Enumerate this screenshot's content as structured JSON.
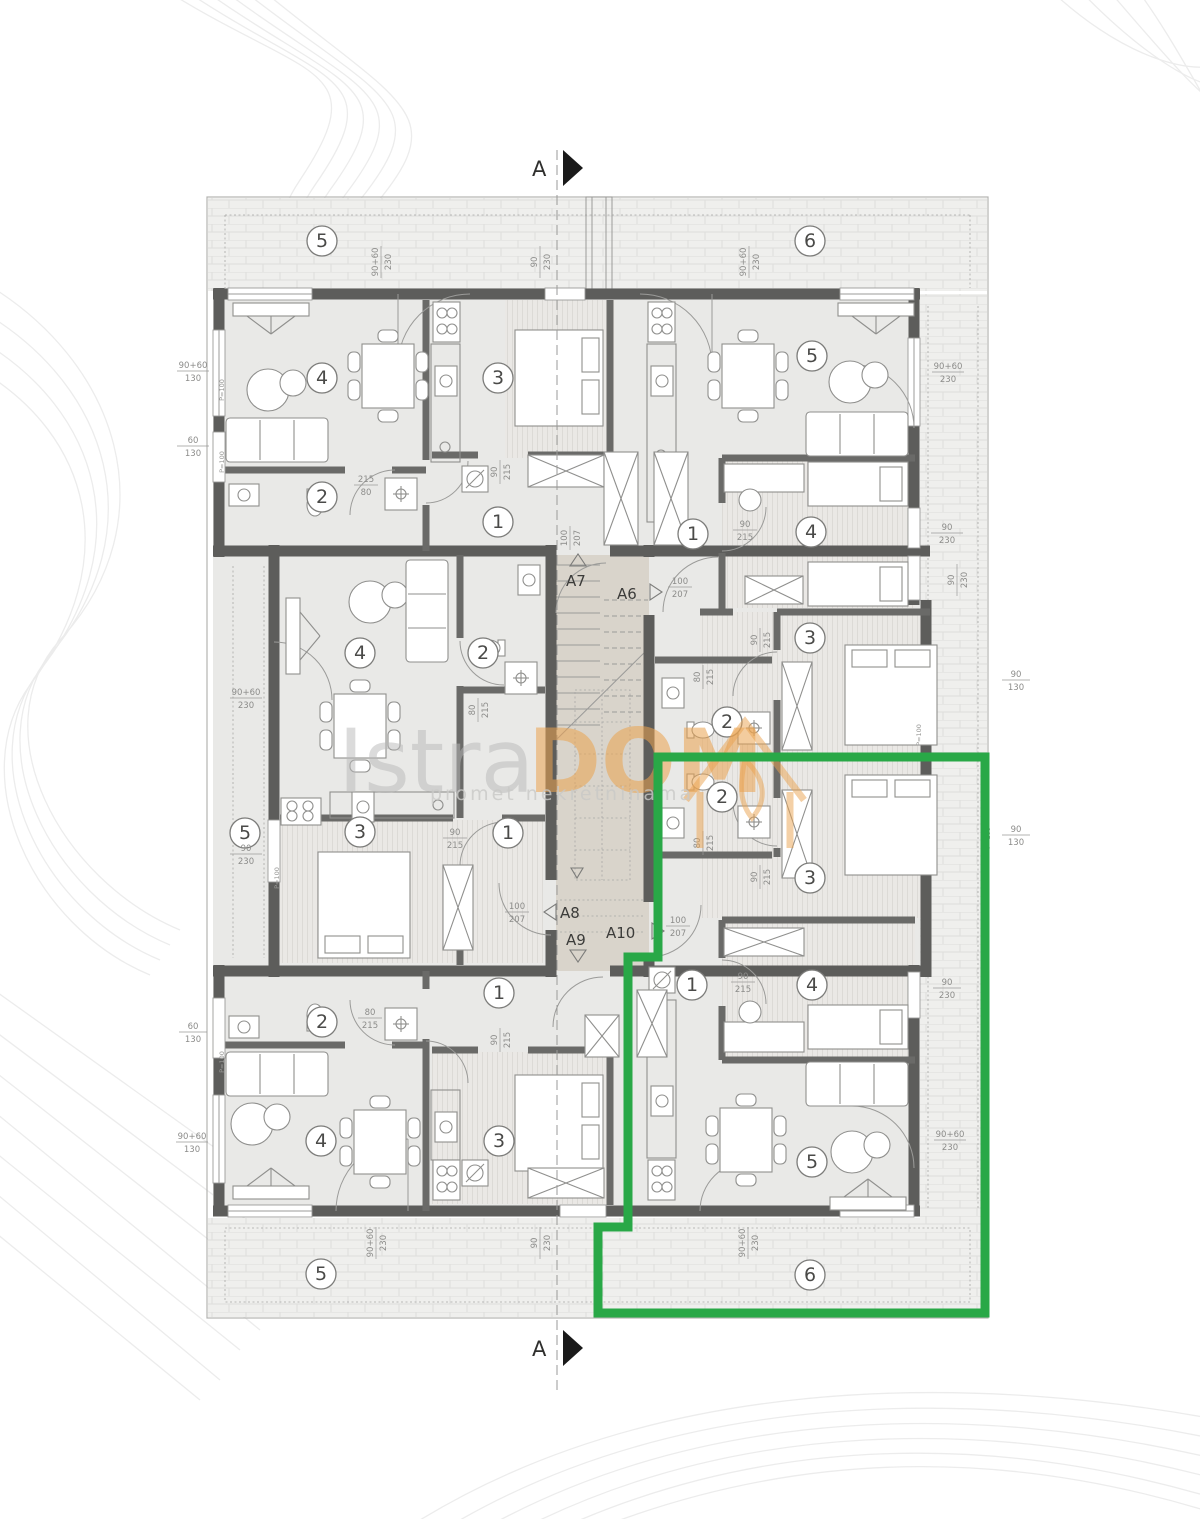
{
  "section": {
    "letter": "A"
  },
  "watermark": {
    "brand_gray": "Istra",
    "brand_orange": "DOM",
    "tagline": "promet nekretninama",
    "orange_hex": "#eba34f",
    "gray_hex": "#bdbdbd"
  },
  "colors": {
    "outline_green": "#29a847",
    "wall_gray": "#5d5d5b",
    "stair_fill": "#d9d4cb",
    "room_fill": "#e9e9e7"
  },
  "apartment_labels": [
    {
      "id": "a7",
      "text": "A7",
      "arrow": "up"
    },
    {
      "id": "a6",
      "text": "A6",
      "arrow": "right"
    },
    {
      "id": "a8",
      "text": "A8",
      "arrow": "left"
    },
    {
      "id": "a9",
      "text": "A9",
      "arrow": "down"
    },
    {
      "id": "a10",
      "text": "A10",
      "arrow": "right"
    }
  ],
  "rooms": [
    {
      "v": "5"
    },
    {
      "v": "4"
    },
    {
      "v": "3"
    },
    {
      "v": "2"
    },
    {
      "v": "1"
    },
    {
      "v": "6"
    },
    {
      "v": "5"
    },
    {
      "v": "1"
    },
    {
      "v": "4"
    },
    {
      "v": "3"
    },
    {
      "v": "2"
    },
    {
      "v": "5"
    },
    {
      "v": "4"
    },
    {
      "v": "2"
    },
    {
      "v": "3"
    },
    {
      "v": "1"
    },
    {
      "v": "2"
    },
    {
      "v": "3"
    },
    {
      "v": "1"
    },
    {
      "v": "4"
    },
    {
      "v": "5"
    },
    {
      "v": "6"
    },
    {
      "v": "2"
    },
    {
      "v": "1"
    },
    {
      "v": "4"
    },
    {
      "v": "3"
    },
    {
      "v": "5"
    }
  ],
  "dims": [
    {
      "a": "90+60",
      "b": "230"
    },
    {
      "a": "90",
      "b": "230"
    },
    {
      "a": "90+60",
      "b": "230"
    },
    {
      "a": "90+60",
      "b": "130"
    },
    {
      "a": "60",
      "b": "130"
    },
    {
      "a": "90+60",
      "b": "230"
    },
    {
      "a": "90",
      "b": "230"
    },
    {
      "a": "90",
      "b": "230"
    },
    {
      "a": "90+60",
      "b": "230"
    },
    {
      "a": "90",
      "b": "230"
    },
    {
      "a": "90",
      "b": "130"
    },
    {
      "a": "90",
      "b": "130"
    },
    {
      "a": "60",
      "b": "130"
    },
    {
      "a": "90+60",
      "b": "130"
    },
    {
      "a": "90+60",
      "b": "230"
    },
    {
      "a": "90",
      "b": "230"
    },
    {
      "a": "90+60",
      "b": "230"
    },
    {
      "a": "90",
      "b": "230"
    },
    {
      "a": "90+60",
      "b": "230"
    },
    {
      "a": "215",
      "b": "80"
    },
    {
      "a": "90",
      "b": "215"
    },
    {
      "a": "90",
      "b": "215"
    },
    {
      "a": "100",
      "b": "207"
    },
    {
      "a": "100",
      "b": "207"
    },
    {
      "a": "100",
      "b": "207"
    },
    {
      "a": "100",
      "b": "207"
    },
    {
      "a": "80",
      "b": "215"
    },
    {
      "a": "80",
      "b": "215"
    },
    {
      "a": "80",
      "b": "215"
    },
    {
      "a": "90",
      "b": "215"
    },
    {
      "a": "90",
      "b": "215"
    },
    {
      "a": "90",
      "b": "215"
    },
    {
      "a": "80",
      "b": "215"
    },
    {
      "a": "90",
      "b": "215"
    },
    {
      "a": "90",
      "b": "215"
    }
  ],
  "window_mark": "P=100"
}
